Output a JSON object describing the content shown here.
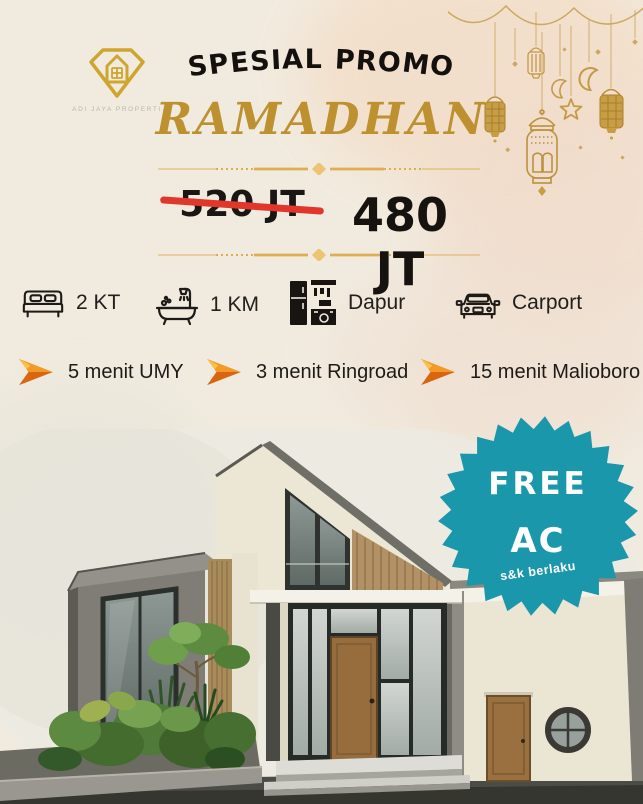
{
  "poster": {
    "brand": {
      "logo_icon": "diamond-house-logo-icon",
      "tagline": "ADI JAYA PROPERTI"
    },
    "header": {
      "kicker": "SPESIAL PROMO",
      "title": "RAMADHAN"
    },
    "pricing": {
      "old_price": "520 JT",
      "new_price": "480 JT"
    },
    "features": [
      {
        "icon": "bed-icon",
        "label": "2 KT"
      },
      {
        "icon": "bathtub-icon",
        "label": "1 KM"
      },
      {
        "icon": "kitchen-icon",
        "label": "Dapur"
      },
      {
        "icon": "car-icon",
        "label": "Carport"
      }
    ],
    "locations": [
      {
        "icon": "direction-arrow-icon",
        "label": "5 menit UMY"
      },
      {
        "icon": "direction-arrow-icon",
        "label": "3 menit Ringroad"
      },
      {
        "icon": "direction-arrow-icon",
        "label": "15 menit Malioboro"
      }
    ],
    "badge": {
      "line1": "FREE",
      "line2": "AC",
      "note": "s&k berlaku"
    },
    "decorations": [
      "bunting",
      "lantern-icon",
      "crescent-moon-icon",
      "star-icon",
      "sparkle-icon"
    ],
    "colors": {
      "gold": "#bd9030",
      "teal": "#1b97ac",
      "orange": "#ed7d1f",
      "strike_red": "#e0372a",
      "ink": "#15120f",
      "background_cream": "#f1ebdf"
    }
  }
}
